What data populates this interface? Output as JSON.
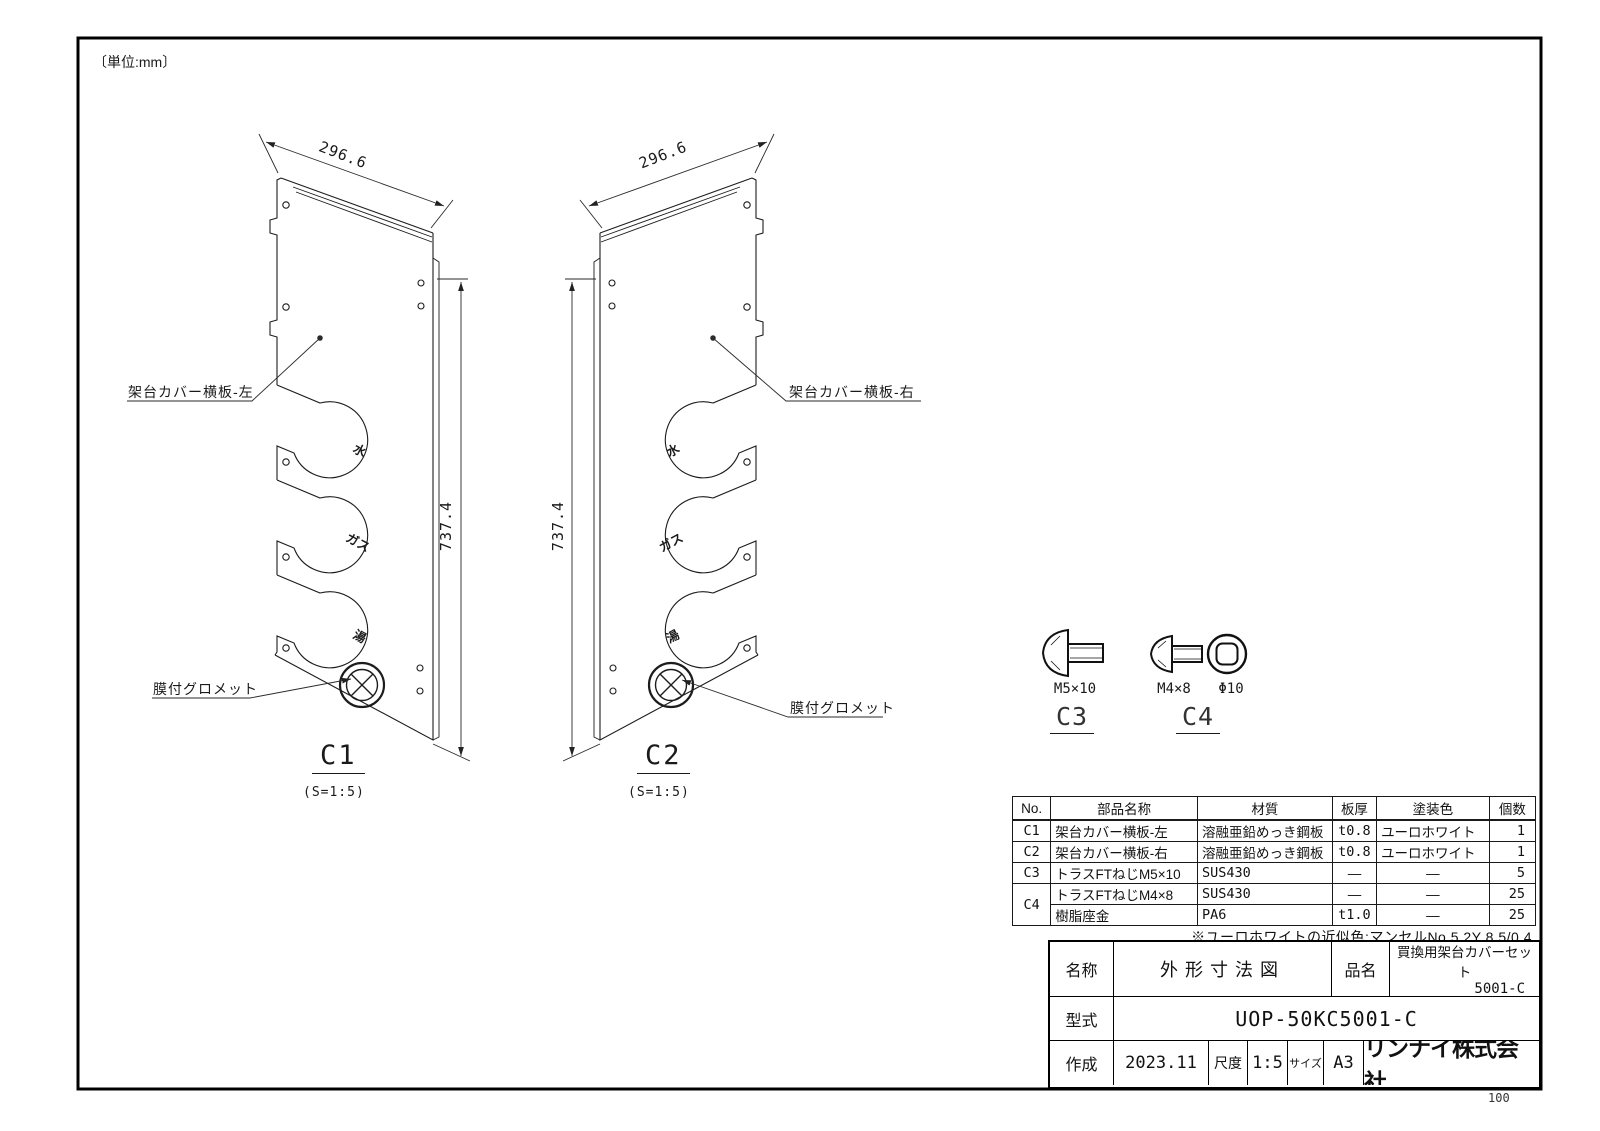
{
  "unit_label": "〔単位:mm〕",
  "views": {
    "c1": {
      "id": "C1",
      "scale": "(S=1:5)",
      "width_dim": "296.6",
      "height_dim": "737.4",
      "part_label": "架台カバー横板-左",
      "grommet_label": "膜付グロメット",
      "ports": [
        "水",
        "ガス",
        "湯"
      ]
    },
    "c2": {
      "id": "C2",
      "scale": "(S=1:5)",
      "width_dim": "296.6",
      "height_dim": "737.4",
      "part_label": "架台カバー横板-右",
      "grommet_label": "膜付グロメット",
      "ports": [
        "水",
        "ガス",
        "湯"
      ]
    }
  },
  "fasteners": {
    "c3": {
      "id": "C3",
      "screw_size": "M5×10"
    },
    "c4": {
      "id": "C4",
      "screw_size": "M4×8",
      "washer_size": "Φ10"
    }
  },
  "parts_table": {
    "headers": [
      "No.",
      "部品名称",
      "材質",
      "板厚",
      "塗装色",
      "個数"
    ],
    "rows": [
      {
        "no": "C1",
        "name": "架台カバー横板-左",
        "material": "溶融亜鉛めっき鋼板",
        "thickness": "t0.8",
        "color": "ユーロホワイト",
        "qty": "1"
      },
      {
        "no": "C2",
        "name": "架台カバー横板-右",
        "material": "溶融亜鉛めっき鋼板",
        "thickness": "t0.8",
        "color": "ユーロホワイト",
        "qty": "1"
      },
      {
        "no": "C3",
        "name": "トラスFTねじM5×10",
        "material": "SUS430",
        "thickness": "—",
        "color": "—",
        "qty": "5"
      },
      {
        "no": "C4",
        "name": "トラスFTねじM4×8",
        "material": "SUS430",
        "thickness": "—",
        "color": "—",
        "qty": "25"
      },
      {
        "no": "C4",
        "name": "樹脂座金",
        "material": "PA6",
        "thickness": "t1.0",
        "color": "—",
        "qty": "25"
      }
    ],
    "note": "※ユーロホワイトの近似色:マンセルNo.5.2Y 8.5/0.4"
  },
  "title_block": {
    "name_label": "名称",
    "name_value": "外形寸法図",
    "product_label": "品名",
    "product_value_line1": "買換用架台カバーセット",
    "product_value_line2": "5001-C",
    "model_label": "型式",
    "model_value": "UOP-50KC5001-C",
    "created_label": "作成",
    "created_value": "2023.11",
    "scale_label": "尺度",
    "scale_value": "1:5",
    "size_label": "サイズ",
    "size_value": "A3",
    "company": "リンナイ株式会社"
  },
  "page_number": "100",
  "colors": {
    "line": "#1c1c1c",
    "background": "#ffffff"
  }
}
